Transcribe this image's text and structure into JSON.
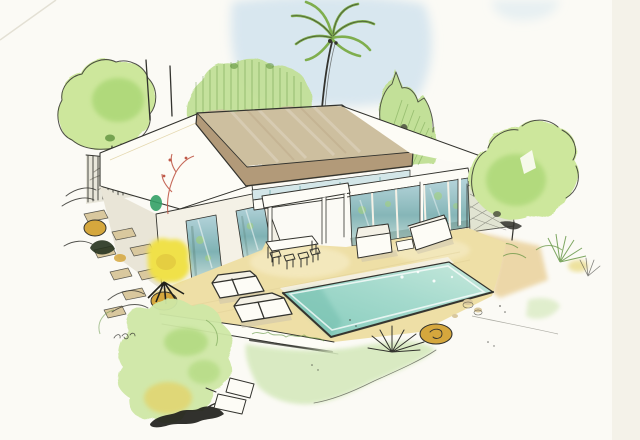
{
  "illustration": {
    "kind": "watercolor-architectural-sketch",
    "subject": "modern flat-roof villa with swimming pool, deck, palm tree and garden"
  },
  "palette": {
    "paper": "#fbfaf5",
    "paper_shade": "#f1eee4",
    "crease": "#ddd9cc",
    "sky": "#cfe2ed",
    "ink": "#33332e",
    "ink_soft": "#77776c",
    "canopy_top": "#cdbf9f",
    "canopy_front": "#b29a79",
    "canopy_shade": "#96805f",
    "clerestory": "#d3e6e8",
    "glass_hi": "#b3d3da",
    "glass_mid": "#7fb2b4",
    "glass_lo": "#c8ded9",
    "glass_dark": "#587f74",
    "white_wall": "#fdfcf6",
    "wall_tint": "#f4f1e6",
    "wall_shadow": "#e9e5d7",
    "deck": "#eedfa6",
    "deck_light": "#f7eecb",
    "deck_line": "#d9c88f",
    "ochre_ground": "#e9cf96",
    "lawn": "#d6e9bd",
    "lawn_deep": "#b9d796",
    "hedge": "#c2e098",
    "tree_light": "#cde79c",
    "tree_green": "#a4d46e",
    "tree_dark": "#5f923d",
    "palm_green": "#7fae4e",
    "bush_soft": "#cfe8a6",
    "bush_yellow": "#e4d266",
    "yellow": "#f0e14a",
    "yellow_deep": "#dfc63e",
    "ochre": "#d5a73d",
    "stone": "#d9c89e",
    "fence": "#d8d6c3",
    "lattice": "#d8dcc6",
    "red_accent": "#c05a49",
    "pool_deep": "#84cbbb",
    "pool_mid": "#a5dacd",
    "pool_light": "#c9eadd",
    "pool_shade": "#6fbcab",
    "smear": "#20201b",
    "shadow_warm": "#c9c2ac"
  },
  "scene": {
    "elements": [
      "sky-wash",
      "palm-tree",
      "back-hedge",
      "tall-hedge-right",
      "round-tree-left",
      "round-tree-right",
      "antenna-poles",
      "slat-fence",
      "left-wing",
      "canopy-roof",
      "clerestory-window",
      "porch-slab",
      "glass-wall",
      "columns",
      "right-eave",
      "lattice-fence",
      "wood-deck",
      "swimming-pool",
      "sun-loungers",
      "dining-set",
      "lounge-sofas",
      "stepping-stones",
      "boulders",
      "yellow-plant",
      "lawn-wash",
      "garden-bush",
      "agave-plant",
      "grasses",
      "garden-steps"
    ]
  }
}
